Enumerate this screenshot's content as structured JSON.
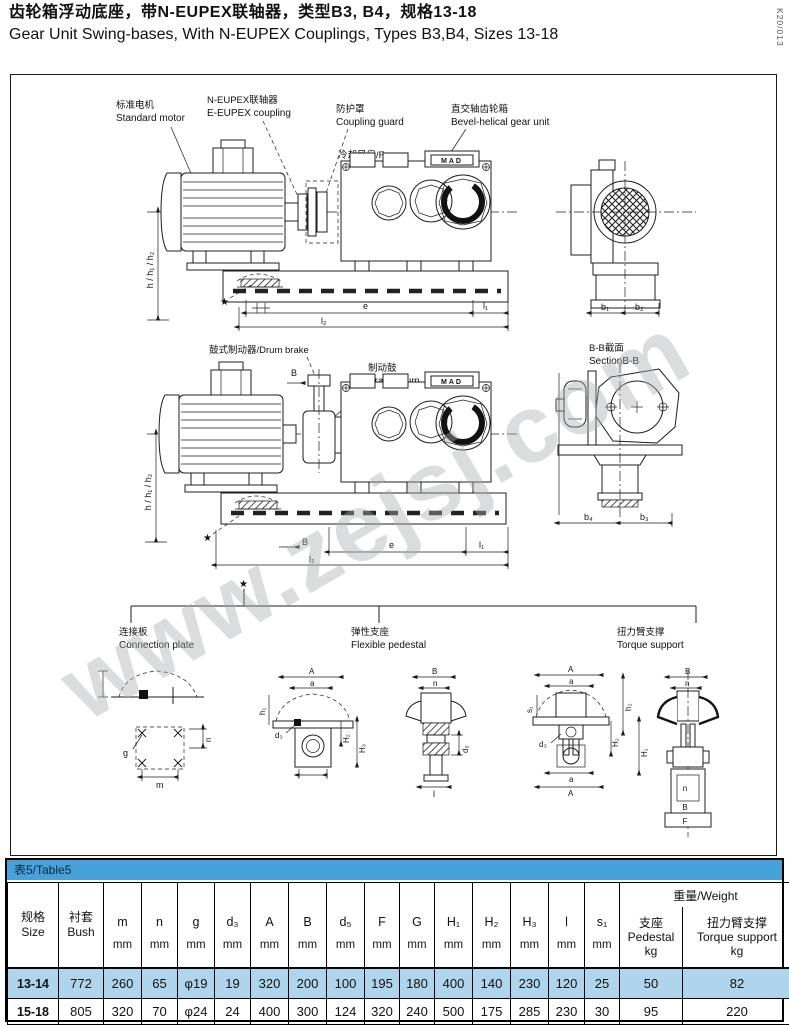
{
  "header": {
    "title_zh": "齿轮箱浮动底座，带N-EUPEX联轴器，类型B3, B4，规格13-18",
    "title_en": "Gear Unit Swing-bases, With N-EUPEX Couplings, Types B3,B4, Sizes 13-18",
    "doc_code": "K20/013"
  },
  "watermark": "www.zejsj.com",
  "drawing1": {
    "motor_zh": "标准电机",
    "motor_en": "Standard motor",
    "coupling_zh": "N-EUPEX联轴器",
    "coupling_en": "E-EUPEX coupling",
    "guard_zh": "防护罩",
    "guard_en": "Coupling guard",
    "fan": "冷却风扇/Fan",
    "gear_zh": "直交轴齿轮箱",
    "gear_en": "Bevel-helical gear unit",
    "nameplate": "MAD",
    "star": "★",
    "dim_h": "h / h₁ / h₂",
    "dim_e": "e",
    "dim_l1": "l₁",
    "dim_l2": "l₂",
    "dim_b1": "b₁",
    "dim_b2": "b₂"
  },
  "drawing2": {
    "brake_label": "鼓式制动器/Drum brake",
    "drum_zh": "制动鼓",
    "drum_en": "Brake drum",
    "section_zh": "B-B截面",
    "section_en": "SectionB-B",
    "nameplate": "MAD",
    "star": "★",
    "dim_h": "h / h₁ / h₂",
    "dim_B_top": "B",
    "dim_B_bot": "B",
    "dim_e": "e",
    "dim_l1": "l₁",
    "dim_l2": "l₂",
    "dim_b4": "b₄",
    "dim_b3": "b₃"
  },
  "options": {
    "star": "★",
    "connection_plate_zh": "连接板",
    "connection_plate_en": "Connection plate",
    "flexible_pedestal_zh": "弹性支座",
    "flexible_pedestal_en": "Flexible pedestal",
    "torque_support_zh": "扭力臂支撑",
    "torque_support_en": "Torque support"
  },
  "details": {
    "plate": {
      "g": "g",
      "m": "m",
      "n": "n"
    },
    "pedestal_front": {
      "A": "A",
      "a": "a",
      "h1": "h₁",
      "d3": "d₃",
      "H2": "H₂",
      "H3": "H₃"
    },
    "pedestal_side": {
      "B": "B",
      "n": "n",
      "d5": "d₅",
      "l": "l"
    },
    "torque_front": {
      "A": "A",
      "a": "a",
      "s1": "s₁",
      "h2": "h₂",
      "d3": "d₃",
      "H2": "H₂",
      "H1": "H₁",
      "a2": "a",
      "A2": "A"
    },
    "torque_side": {
      "B": "B",
      "n": "n",
      "n2": "n",
      "B2": "B",
      "F": "F"
    }
  },
  "table": {
    "caption": "表5/Table5",
    "col_size": [
      "规格",
      "Size"
    ],
    "col_bush": [
      "衬套",
      "Bush"
    ],
    "unit_cols": [
      {
        "sym": "m",
        "unit": "mm"
      },
      {
        "sym": "n",
        "unit": "mm"
      },
      {
        "sym": "g",
        "unit": "mm"
      },
      {
        "sym": "d₃",
        "unit": "mm"
      },
      {
        "sym": "A",
        "unit": "mm"
      },
      {
        "sym": "B",
        "unit": "mm"
      },
      {
        "sym": "d₅",
        "unit": "mm"
      },
      {
        "sym": "F",
        "unit": "mm"
      },
      {
        "sym": "G",
        "unit": "mm"
      },
      {
        "sym": "H₁",
        "unit": "mm"
      },
      {
        "sym": "H₂",
        "unit": "mm"
      },
      {
        "sym": "H₃",
        "unit": "mm"
      },
      {
        "sym": "l",
        "unit": "mm"
      },
      {
        "sym": "s₁",
        "unit": "mm"
      }
    ],
    "weight_group": "重量/Weight",
    "col_pedestal": [
      "支座",
      "Pedestal",
      "kg"
    ],
    "col_torque": [
      "扭力臂支撑",
      "Torque support",
      "kg"
    ],
    "rows": [
      {
        "size": "13-14",
        "bush": "772",
        "values": [
          "260",
          "65",
          "φ19",
          "19",
          "320",
          "200",
          "100",
          "195",
          "180",
          "400",
          "140",
          "230",
          "120",
          "25"
        ],
        "pedestal": "50",
        "torque": "82"
      },
      {
        "size": "15-18",
        "bush": "805",
        "values": [
          "320",
          "70",
          "φ24",
          "24",
          "400",
          "300",
          "124",
          "320",
          "240",
          "500",
          "175",
          "285",
          "230",
          "30"
        ],
        "pedestal": "95",
        "torque": "220"
      }
    ],
    "colors": {
      "caption_bg": "#46a2d9",
      "row_highlight_bg": "#aed5ec"
    }
  }
}
